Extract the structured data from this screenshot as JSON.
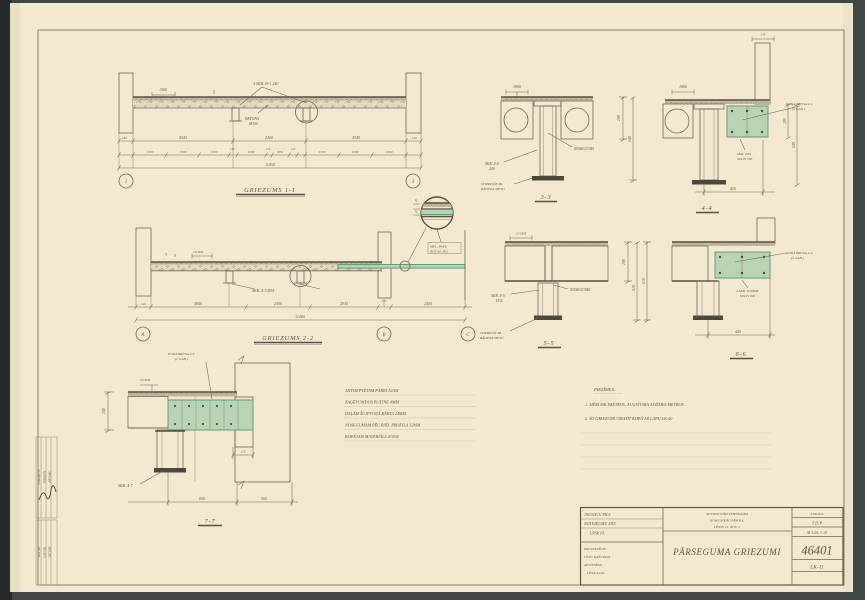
{
  "page": {
    "background": "#3e4744",
    "paper": "#f2e9d0",
    "pencil": "#6e6758",
    "accent_green": "#b8d4b2"
  },
  "s11": {
    "title": "GRIEZUMS 1-1",
    "bubble_left": "1",
    "bubble_right": "3",
    "label_skr": "4 SKR. Ø-1 240",
    "label_1000": "1000",
    "label_50": "50",
    "label_betons_1": "BETONS",
    "label_betons_2": "M100",
    "dims_row1": [
      "140",
      "4545",
      "2400",
      "4545",
      "140"
    ],
    "dims_row2": [
      "1500",
      "1500",
      "1500",
      "140",
      "1500",
      "120",
      "800",
      "120",
      "1500",
      "1500",
      "1500"
    ],
    "dim_total": "11450"
  },
  "s22": {
    "title": "GRIEZUMS 2-2",
    "bubbles": [
      "A",
      "B",
      "C"
    ],
    "label_skr": "SKR. 4-3 Ø34",
    "label_v1": "20",
    "label_v2": "65",
    "label_10mm": "10 MM",
    "detail_line1": "MEL. PAPE",
    "detail_line2": "BITUM. M-2",
    "detail_d1": "20",
    "detail_d2": "40",
    "dims_row": [
      "140",
      "3840",
      "2400",
      "2840",
      "380",
      "2400"
    ],
    "dim_total": "11480"
  },
  "s33": {
    "title": "3-3",
    "label_1000": "1000",
    "label_skr_1": "SKR. 4-4",
    "label_skr_2": "240",
    "label_noseg": "NOSEGUMS",
    "label_stip_1": "STIPRINĀT PA",
    "label_stip_2": "RĀDEŅA METU",
    "dim_a": "280",
    "dim_b": "640"
  },
  "s44": {
    "title": "4-4",
    "label_1000": "1000",
    "label_brusa_1": "KOKA BRUSA 4-1",
    "label_brusa_2": "(2 GAB.)",
    "label_skr_1": "SKR. Ø16",
    "label_skr_2": "SOLIS 700",
    "dim_a": "280",
    "dim_b": "640",
    "dim_c": "450",
    "dim_top": "140"
  },
  "s55": {
    "title": "5-5",
    "label_10mm": "10 MM",
    "label_skr_1": "SKR. 4-5",
    "label_skr_2": "Ø34",
    "label_noseg": "NOSEGUMS",
    "label_stip_1": "STIPRINĀT PA",
    "label_stip_2": "RĀDEŅA METU",
    "dim_a": "280",
    "dim_b": "610"
  },
  "s66": {
    "title": "6-6",
    "label_brusa_1": "KOKA BRUSA 2-2",
    "label_brusa_2": "(2 GAB.)",
    "label_skr_1": "4 SKR. Ø16MM",
    "label_skr_2": "SOLIS 800",
    "dim_a": "610",
    "dim_b": "440"
  },
  "s77": {
    "title": "7-7",
    "label_brusa_1": "KOKA BRUSA 4-5",
    "label_brusa_2": "(2 GAB.)",
    "label_20mm": "20 MM",
    "label_skr": "SKR. 4-7",
    "dim_a": "240",
    "dim_b": "120",
    "dim_c": "800",
    "dim_d": "980"
  },
  "spec_notes": {
    "lines": [
      "ANTISEPTĒTAM PĀRKLĀJAM",
      "ZAĢĒVUMDOS PLĀTNE 4MM",
      "DAĻĀM ŠUJPVOŅĀ KĀRTA 24MM",
      "NOSEGUMAM PĒC RĀD. PROFILA 32MM",
      "KOPĒJAIS MATERIĀLS 4/30M"
    ]
  },
  "piezimes": {
    "header": "PIEZĪMES:",
    "items": [
      "1. MĒRI MILIMETROS, AUGSTUMA ATZĪMES METROS.",
      "2. ŠO GRIEZUMU SKATĪT KOPĀ AR LAPU LK-40"
    ]
  },
  "title_block": {
    "client_lines": [
      "JAUNAVU PILS",
      "NOTEIKUMU MIN.",
      "LPSR PL"
    ],
    "author_lines": [
      "PROJEKTĒJIS:",
      "LĒNU RAŽOTAVA",
      "APVIENĪBA:",
      "LĒNA ALVA"
    ],
    "org_lines": [
      "APVIENOTĀM TEHNISKĀM",
      "KOMUNIKĀCIJĀM P.S.",
      "LĒNIN 21. NOV. 2"
    ],
    "sheet_title": "PĀRSEGUMA GRIEZUMI",
    "stage_label": "STADIJA",
    "stage_value": "T.D.P",
    "scale_value": "M 1:20, 1:10",
    "object_number": "46401",
    "sheet_number": "LK-11"
  },
  "margin": {
    "block1": [
      "SASKAŅOTS",
      "PARAKSTS",
      "DATUMS"
    ],
    "block2": [
      "IZM. NR.",
      "LAPA NR.",
      "DATUMS"
    ]
  }
}
